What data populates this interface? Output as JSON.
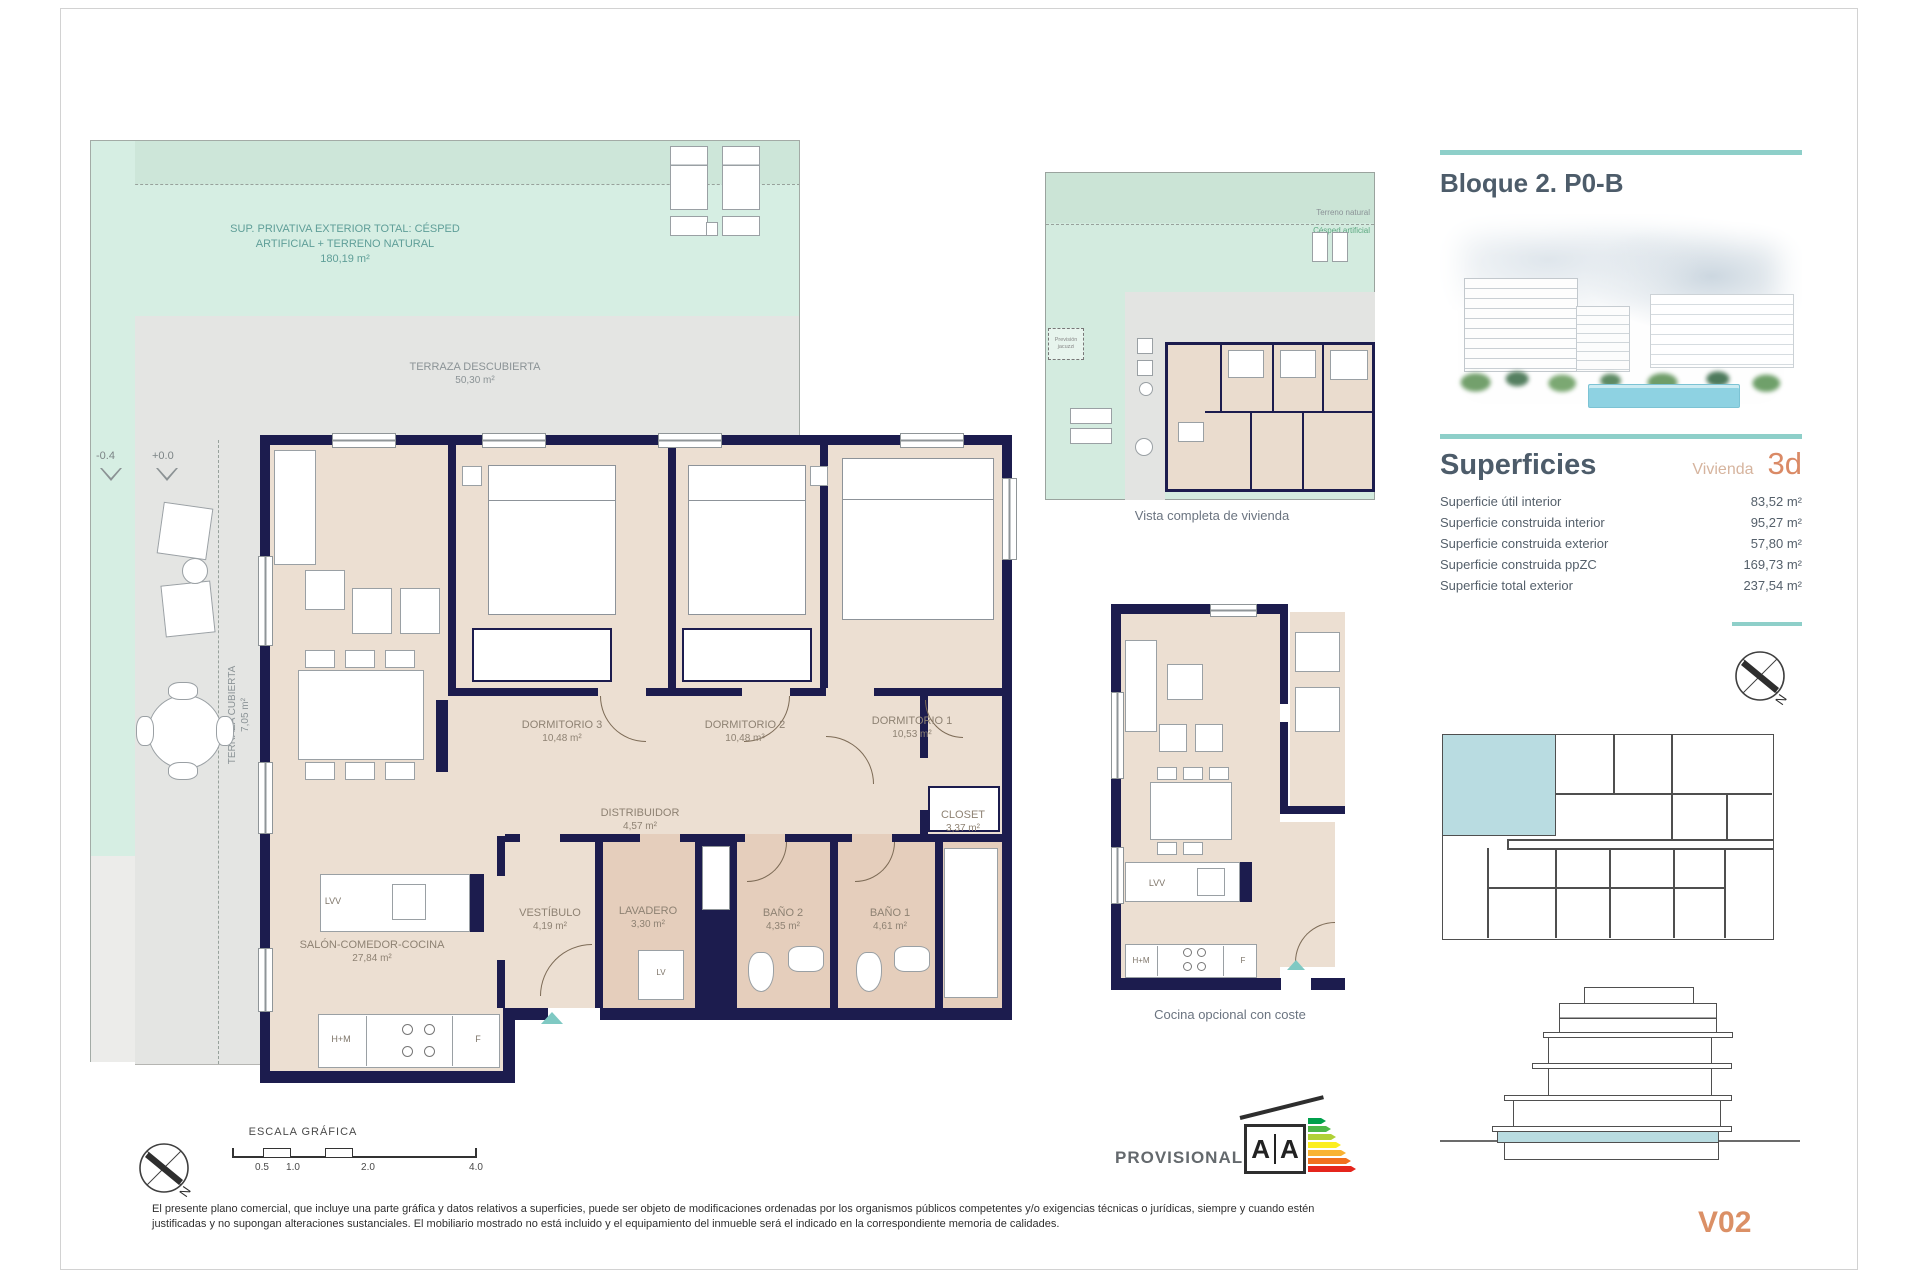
{
  "colors": {
    "wall_navy": "#1c1c4e",
    "mint_green": "#d6eee3",
    "terrace_gray": "#e4e5e3",
    "floor_beige": "#ecdfd2",
    "wet_room_tan": "#e5cebc",
    "teal_accent": "#8ecfc9",
    "heading_slate": "#4d5c6a",
    "salmon_accent": "#db8a64",
    "subtitle_tan": "#d6b49e",
    "unit_highlight_blue": "#b9dce1"
  },
  "header": {
    "title": "Bloque 2. P0-B"
  },
  "superficies": {
    "title": "Superficies",
    "subtitle": "Vivienda",
    "unit": "3d",
    "rows": [
      {
        "label": "Superficie útil interior",
        "value": "83,52 m²"
      },
      {
        "label": "Superficie construida interior",
        "value": "95,27 m²"
      },
      {
        "label": "Superficie construida exterior",
        "value": "57,80 m²"
      },
      {
        "label": "Superficie construida ppZC",
        "value": "169,73 m²"
      },
      {
        "label": "Superficie total exterior",
        "value": "237,54 m²"
      }
    ]
  },
  "version": "V02",
  "compass": {
    "n": "N"
  },
  "provisional": {
    "label": "PROVISIONAL",
    "energy_left": "A",
    "energy_right": "A"
  },
  "scale": {
    "title": "ESCALA GRÁFICA",
    "ticks": [
      "0.5",
      "1.0",
      "2.0",
      "4.0"
    ]
  },
  "disclaimer": "El presente plano comercial, que incluye una parte gráfica y datos relativos a superficies, puede ser objeto de modificaciones ordenadas por los organismos públicos competentes y/o exigencias técnicas o jurídicas, siempre y cuando estén justificadas y no supongan alteraciones sustanciales. El mobiliario mostrado no está incluido y el equipamiento del inmueble será el indicado en la correspondiente memoria de calidades.",
  "main_plan": {
    "exterior_line1": "SUP. PRIVATIVA EXTERIOR TOTAL: CÉSPED",
    "exterior_line2": "ARTIFICIAL + TERRENO NATURAL",
    "exterior_line3": "180,19 m²",
    "terraza_descubierta": {
      "name": "TERRAZA DESCUBIERTA",
      "area": "50,30 m²"
    },
    "terraza_cubierta": {
      "name": "TERRAZA CUBIERTA",
      "area": "7,05 m²"
    },
    "levels": {
      "low": "-0.4",
      "high": "+0.0"
    },
    "rooms": {
      "dormitorio3": {
        "name": "DORMITORIO 3",
        "area": "10,48 m²"
      },
      "dormitorio2": {
        "name": "DORMITORIO 2",
        "area": "10,48 m²"
      },
      "dormitorio1": {
        "name": "DORMITORIO 1",
        "area": "10,53 m²"
      },
      "distribuidor": {
        "name": "DISTRIBUIDOR",
        "area": "4,57 m²"
      },
      "closet": {
        "name": "CLOSET",
        "area": "3,37 m²"
      },
      "vestibulo": {
        "name": "VESTÍBULO",
        "area": "4,19 m²"
      },
      "lavadero": {
        "name": "LAVADERO",
        "area": "3,30 m²"
      },
      "bano2": {
        "name": "BAÑO 2",
        "area": "4,35 m²"
      },
      "bano1": {
        "name": "BAÑO 1",
        "area": "4,61 m²"
      },
      "salon": {
        "name": "SALÓN-COMEDOR-COCINA",
        "area": "27,84 m²"
      }
    },
    "appliances": {
      "island": "LVV",
      "washer": "LV",
      "hm": "H+M",
      "fridge": "F"
    }
  },
  "overview_plan": {
    "caption": "Vista completa de vivienda",
    "terreno_natural": "Terreno natural",
    "cesped_artificial": "Césped artificial",
    "jacuzzi_line1": "Previsión",
    "jacuzzi_line2": "jacuzzi"
  },
  "kitchen_plan": {
    "caption": "Cocina opcional con coste",
    "island": "LVV",
    "hm": "H+M",
    "fridge": "F"
  }
}
